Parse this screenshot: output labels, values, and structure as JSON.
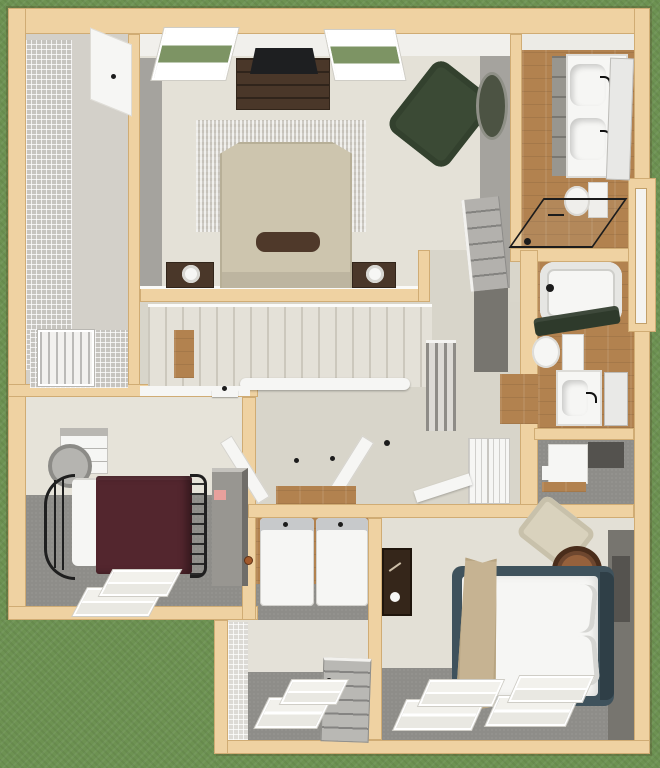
{
  "scene": {
    "type": "floor-plan-3d-render",
    "view": "top-down dollhouse",
    "floor": "upper floor of a house",
    "background": "grass",
    "canvas_px": {
      "width": 660,
      "height": 768
    },
    "visible_text": "none"
  },
  "palette": {
    "grass": "#6d9252",
    "wall_top": "#efd2a2",
    "wall_edge": "#b78c4e",
    "carpet_gray": "#8e8d89",
    "wood_floor": "#b2824f",
    "interior_beige": "#e2dfd5",
    "fixture_white": "#f6f6f4",
    "furniture_dark_brown": "#4a3729",
    "armchair_green": "#3b4a35",
    "duvet_maroon": "#53262e",
    "bed_frame_slate": "#3f525c",
    "master_duvet_tan": "#cdc5ae",
    "towel_green": "#2e3a2b",
    "shower_frame_black": "#1c1c1c"
  },
  "rooms": [
    {
      "name": "walk-in-closet",
      "features": [
        "wire-shelving",
        "louvered-shutter",
        "open-door"
      ]
    },
    {
      "name": "master-bedroom",
      "features": [
        "window-left",
        "window-right",
        "tv",
        "media-dresser",
        "area-rug",
        "bed-tan-duvet",
        "bolster-pillow",
        "nightstand-lamp-left",
        "nightstand-lamp-right",
        "green-armchair",
        "leaning-oval-mirror",
        "panel-door"
      ]
    },
    {
      "name": "master-bathroom",
      "features": [
        "double-vanity",
        "sink-x2",
        "black-faucets",
        "leaning-mirror",
        "toilet",
        "glass-shower",
        "wood-floor"
      ]
    },
    {
      "name": "hall-bathroom",
      "features": [
        "bathtub",
        "green-towel",
        "toilet",
        "vanity-sink",
        "leaning-mirror",
        "wood-floor"
      ]
    },
    {
      "name": "linen-closet",
      "features": [
        "white-shelving",
        "wood-base"
      ]
    },
    {
      "name": "hallway",
      "features": [
        "staircase",
        "white-handrail",
        "stair-balustrade",
        "laundry-bifold-doors",
        "paneled-closet-doors",
        "door-casing"
      ]
    },
    {
      "name": "laundry-closet",
      "features": [
        "washer",
        "dryer",
        "wood-floor"
      ]
    },
    {
      "name": "bedroom-front",
      "features": [
        "wrought-iron-bed",
        "maroon-duvet",
        "white-pillows",
        "dresser",
        "round-mirror",
        "armoire",
        "double-window"
      ]
    },
    {
      "name": "bonus-room",
      "features": [
        "gray-panel-door",
        "double-window",
        "tile-texture-wall"
      ]
    },
    {
      "name": "bedroom-rear",
      "features": [
        "platform-bed-slate-frame",
        "white-bedding",
        "tan-runner",
        "pillows",
        "corner-armchair",
        "round-side-table",
        "grandfather-clock",
        "double-window-x2"
      ]
    }
  ]
}
